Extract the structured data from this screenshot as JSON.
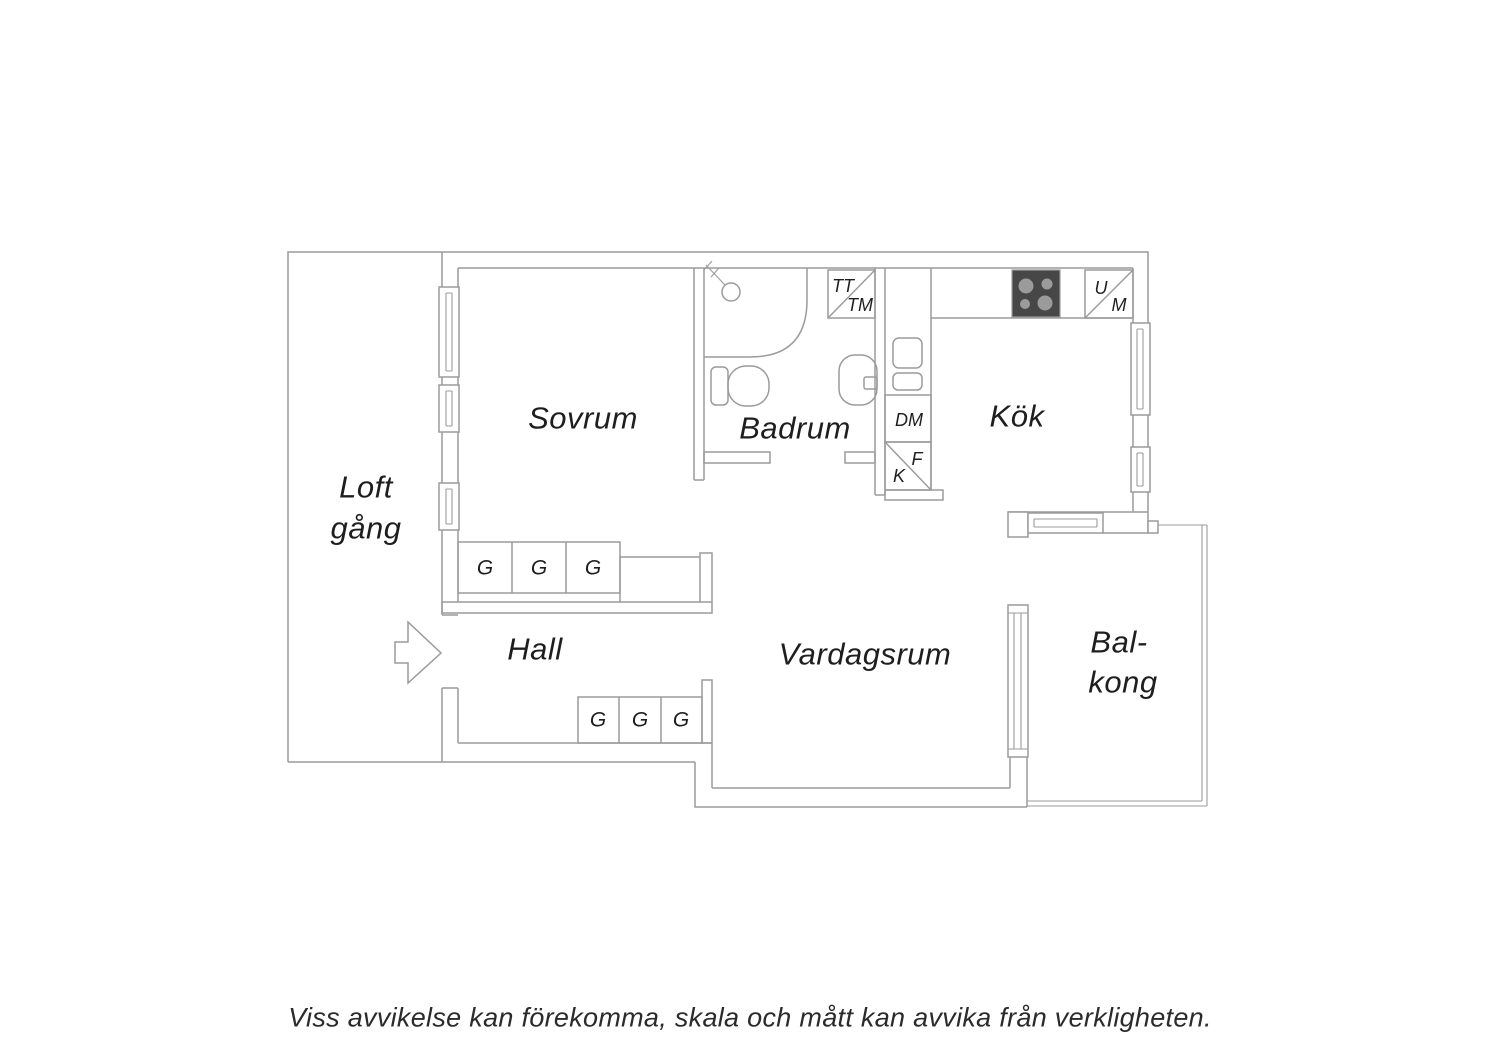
{
  "rooms": {
    "loftgang_line1": "Loft",
    "loftgang_line2": "gång",
    "sovrum": "Sovrum",
    "badrum": "Badrum",
    "kok": "Kök",
    "hall": "Hall",
    "vardagsrum": "Vardagsrum",
    "balkong_line1": "Bal-",
    "balkong_line2": "kong"
  },
  "appliances": {
    "tumble_dryer": "TT",
    "washing_machine": "TM",
    "dishwasher": "DM",
    "freezer": "F",
    "fridge": "K",
    "oven": "U",
    "micro": "M"
  },
  "wardrobe": {
    "label": "G"
  },
  "caption": "Viss avvikelse kan förekomma, skala och mått kan avvika från verkligheten.",
  "colors": {
    "line": "#9b9b9b",
    "text": "#1e1e1e",
    "stove_body": "#474747",
    "stove_burner": "#9b9b9b",
    "background": "#ffffff"
  }
}
